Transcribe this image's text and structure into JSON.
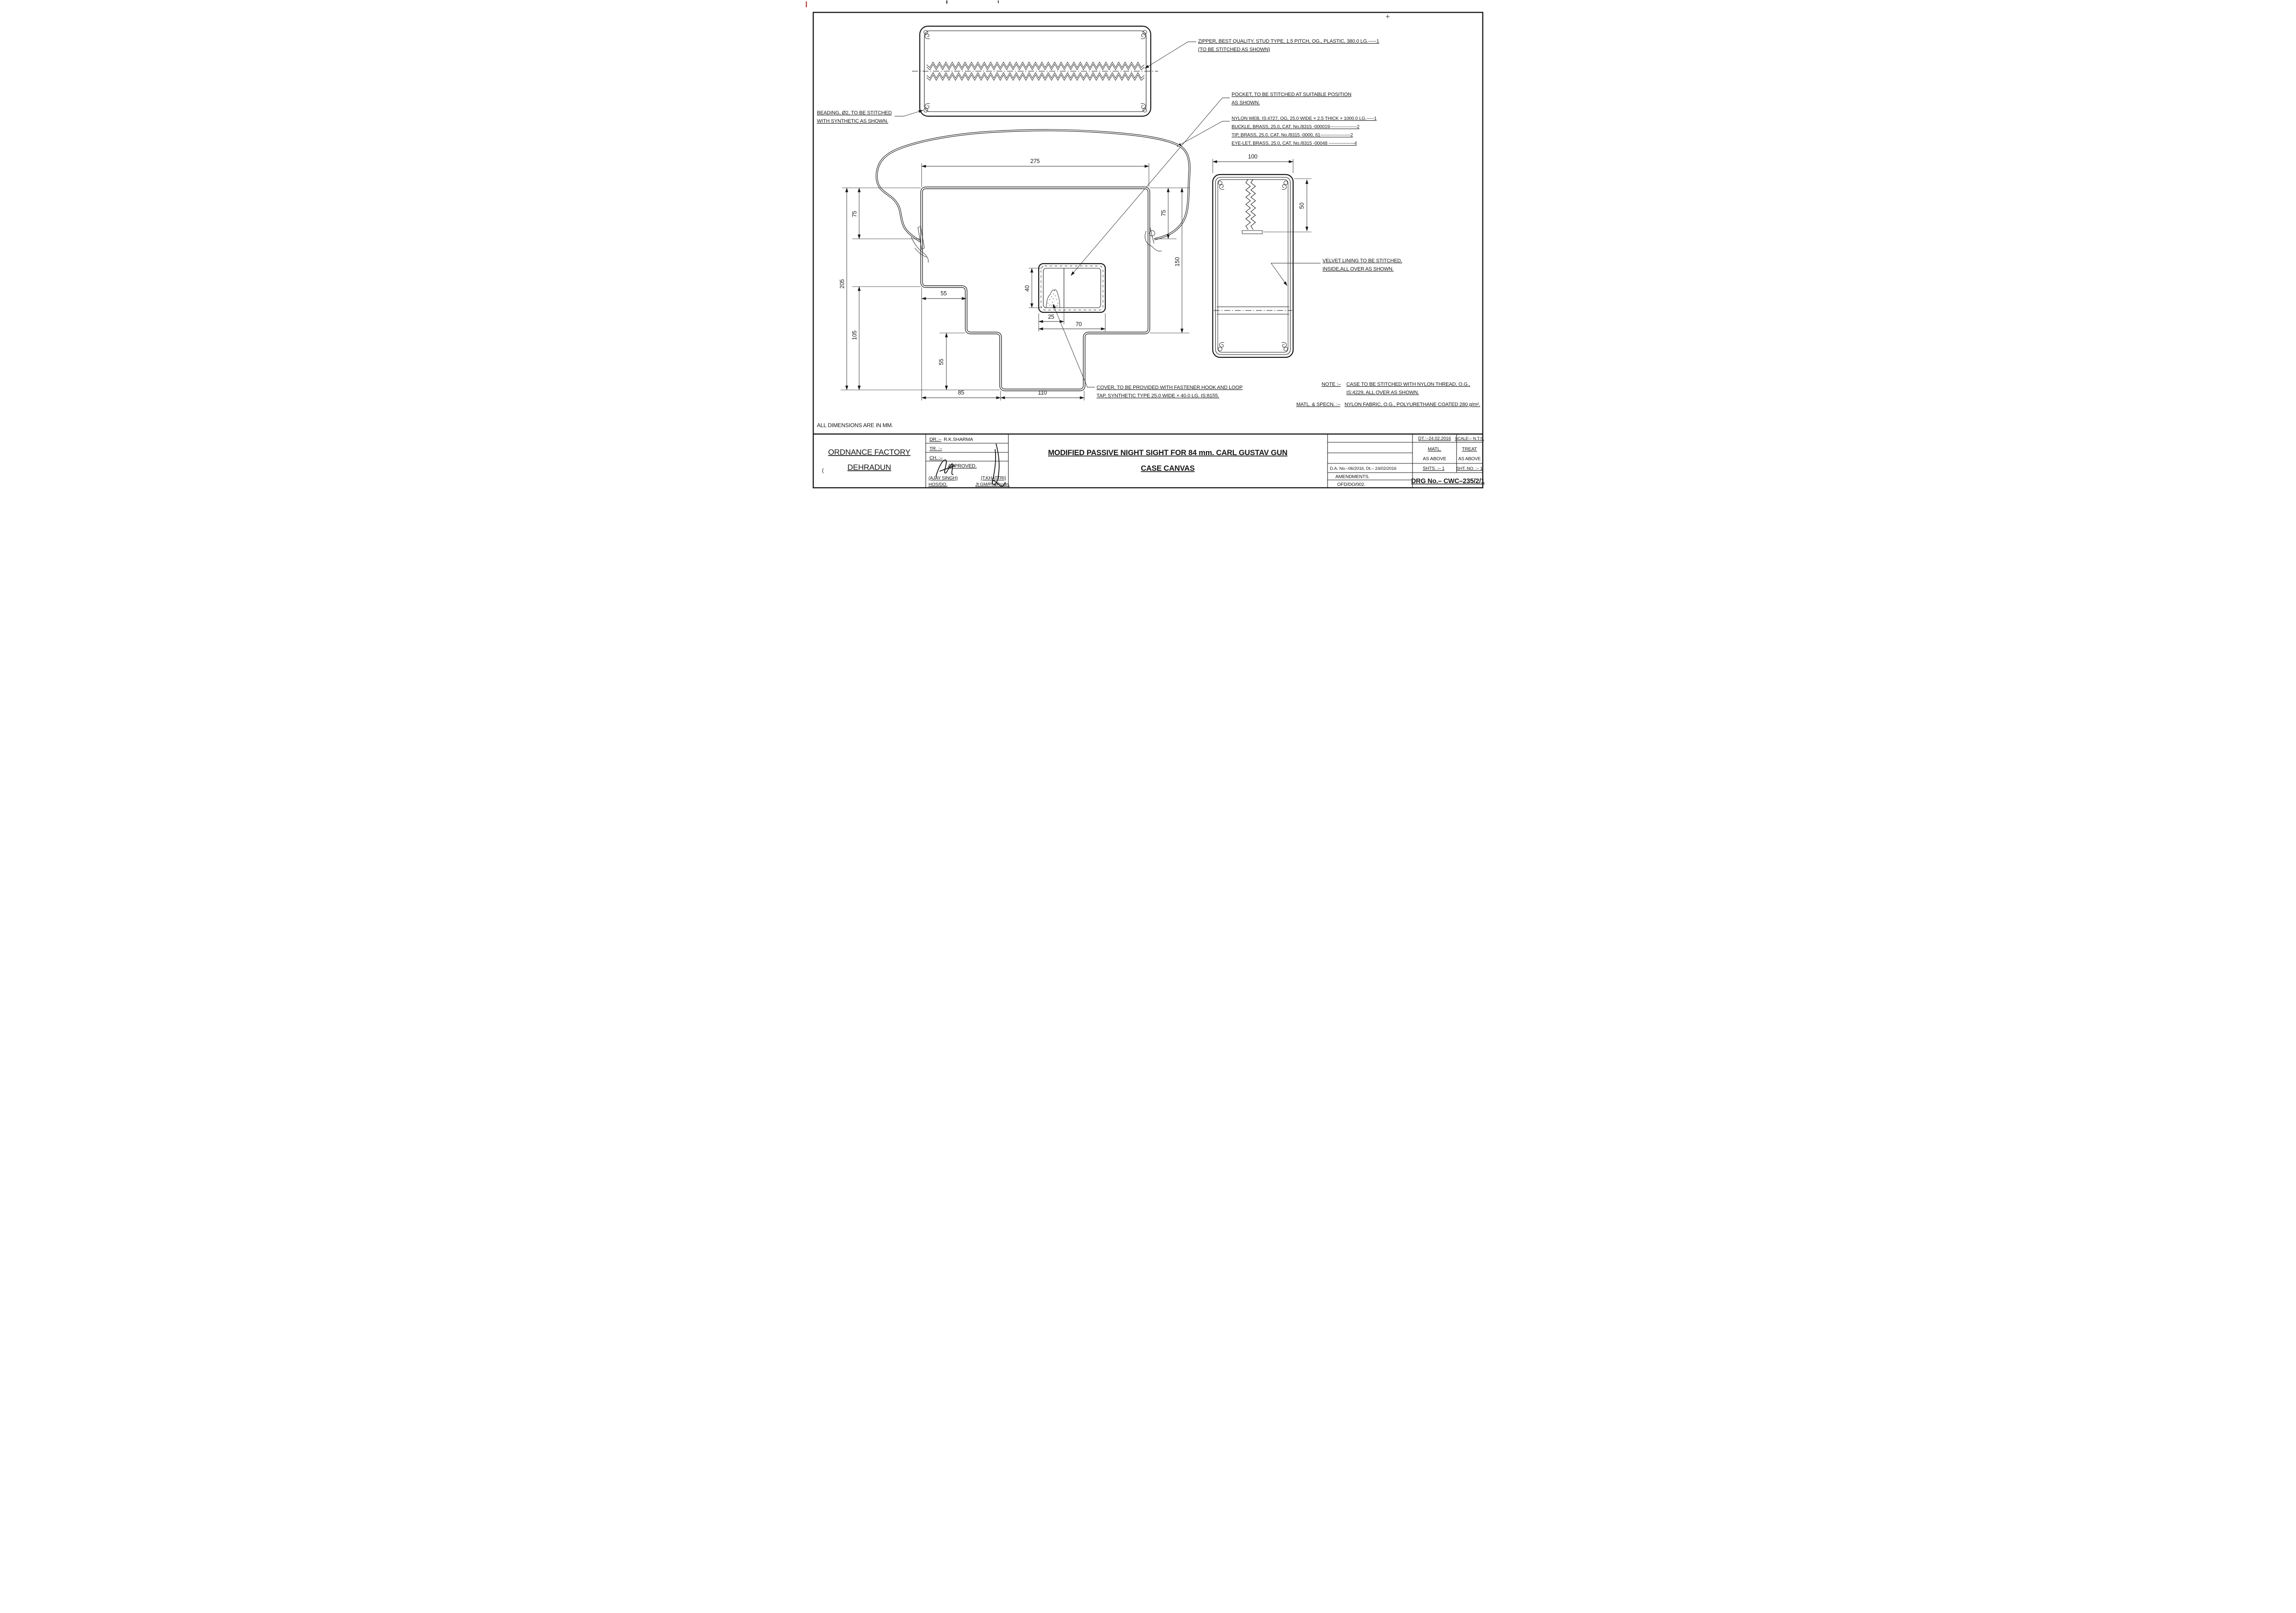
{
  "artifacts": {
    "paren": "("
  },
  "drawing": {
    "all_dims_note": "ALL DIMENSIONS ARE IN MM.",
    "labels": {
      "zipper1": "ZIPPER, BEST QUALITY, STUD TYPE, 1.5 PITCH, OG., PLASTIC, 380.0 LG.-----1",
      "zipper2": "(TO BE STITCHED AS SHOWN)",
      "beading1": "BEADING, Ø2, TO BE STITCHED",
      "beading2": "WITH SYNTHETIC AS SHOWN.",
      "pocket1": "POCKET, TO BE STITCHED AT SUITABLE POSITION",
      "pocket2": "AS SHOWN.",
      "parts": [
        "NYLON WEB, IS:4727, OG, 25.0 WIDE × 2.5 THICK × 1000.0 LG.-----1",
        "BUCKLE, BRASS, 25.0, CAT. No./8315 -000019------------------2",
        "TIP, BRASS, 25.0, CAT. No./8315 -0000, 61--------------------2",
        "EYE-LET, BRASS, 25.0, CAT. No./8315 -00048 -----------------4"
      ],
      "velvet1": "VELVET LINING TO BE STITCHED,",
      "velvet2": "INSIDE,ALL OVER AS SHOWN.",
      "cover1": "COVER, TO BE PROVIDED WITH FASTENER HOOK AND LOOP",
      "cover2": "TAP, SYNTHETIC TYPE 25.0 WIDE × 40.0 LG. IS:8155.",
      "note_label": "NOTE :–",
      "note1": "CASE TO BE STITCHED WITH NYLON THREAD, O.G.,",
      "note2": "IS:4229, ALL OVER AS SHOWN.",
      "matl_label": "MATL. & SPECN. :–",
      "matl_text": "NYLON FABRIC, O.G., POLYURETHANE COATED 280 g/m²."
    },
    "dims": {
      "top_width": "275",
      "left_upper": "75",
      "left_total": "205",
      "left_lower": "105",
      "right_upper": "75",
      "right_total": "150",
      "step_w": "55",
      "step_h": "55",
      "flap_left": "85",
      "flap_w": "110",
      "pocket_h": "40",
      "pocket_div": "25",
      "pocket_w": "70",
      "side_w": "100",
      "side_zip": "50"
    }
  },
  "title_block": {
    "org1": "ORDNANCE FACTORY",
    "org2": "DEHRADUN",
    "dr_label": "DR.:–",
    "dr_value": "R.K.SHARMA",
    "tr_label": "TR. :–",
    "ch_label": "CH. :–",
    "approved": "APPROVED.",
    "sign1_name": "(AJAY SINGH)",
    "sign1_role": "HOS/DO.",
    "sign2_name": "(T.KHATTRI)",
    "sign2_role": "Jt.GM/Pl.&Prodn.",
    "title1": "MODIFIED  PASSIVE NIGHT SIGHT  FOR 84 mm. CARL GUSTAV GUN",
    "title2": "CASE  CANVAS",
    "dt": "DT.:–24.02.2016",
    "scale": "SCALE:– N.T.S.",
    "matl_label": "MATL.",
    "matl_value": "AS ABOVE",
    "treat_label": "TREAT",
    "treat_value": "AS ABOVE",
    "da": "D.A. No.–06/2016, Dt.– 24/02/2016",
    "shts": "SHTS. :–  1",
    "sht_no": "SHT. NO. :–  1",
    "amendments": "AMENDMENTS.",
    "ofd": "OFD/DO/002.",
    "drg_no": "DRG No.– CWC–235/2/1"
  }
}
